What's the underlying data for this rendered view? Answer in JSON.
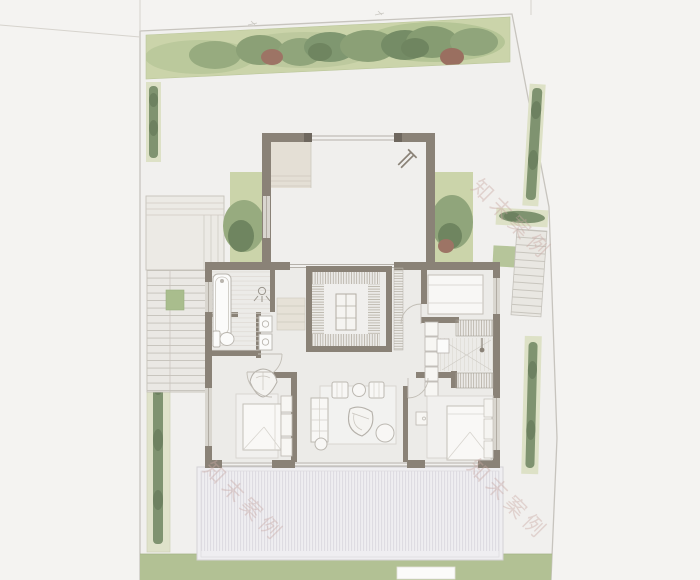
{
  "watermark": {
    "text": "知末案例",
    "color": "#c9a9a4",
    "instances": 3,
    "rotation_deg": 45
  },
  "palette": {
    "bg": "#f4f3f1",
    "site": "#f1f0ee",
    "boundary": "#c7c4be",
    "wall": "#8a8277",
    "wallDark": "#6e675e",
    "gardenBand": "#cbd4aa",
    "bed": "#dde1c6",
    "hedge": "#7f9370",
    "treeRed": "#9d7465",
    "lawn": "#b2c194",
    "landing": "#a9bd8d",
    "floor": "#ecebe8",
    "courtFloor": "#f0efed",
    "stepBeige": "#e4dfd5",
    "deck": "#efeef1",
    "furniture": "#bcb8b1",
    "watermark": "#c9a9a4"
  },
  "scene": {
    "type": "architectural-floor-plan",
    "rooms": [
      "entry-courtyard",
      "bathroom",
      "inner-atrium",
      "hallway",
      "stairwell",
      "bedroom-top-right",
      "bedroom-left",
      "living-room",
      "bedroom-right"
    ],
    "landscape": [
      "tree-border-top",
      "side-hedges",
      "garden-terrace",
      "garden-stairs",
      "outdoor-stairs-right",
      "wood-deck",
      "lawn-strip"
    ]
  }
}
